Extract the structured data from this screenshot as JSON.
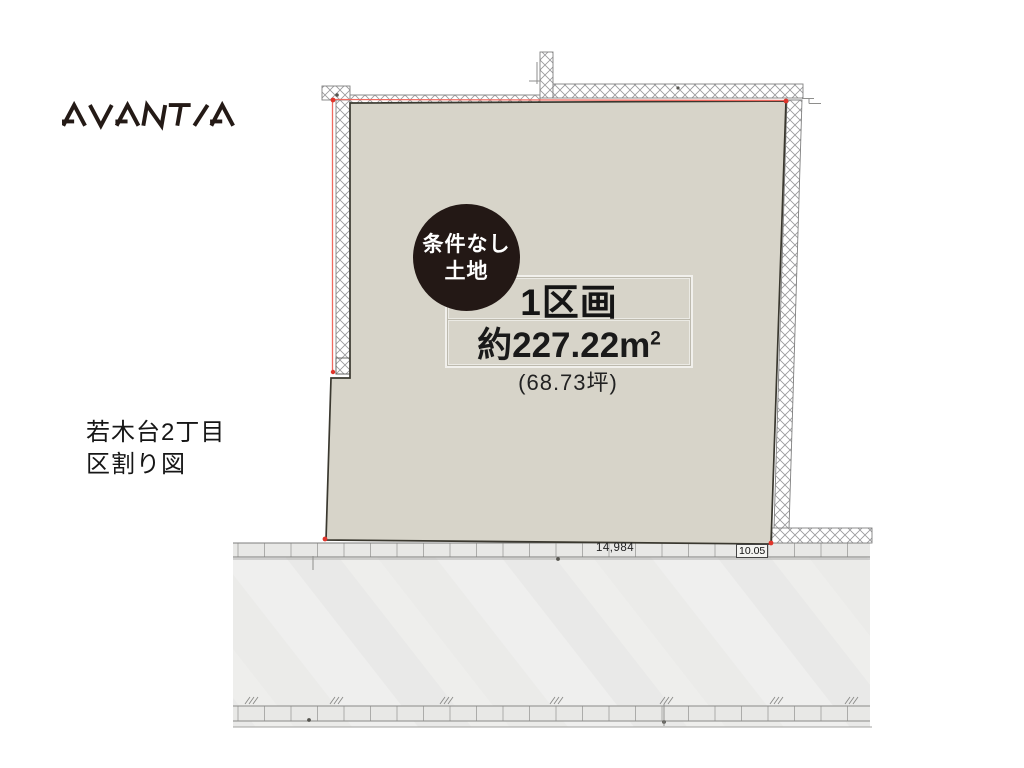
{
  "brand": {
    "name": "AVANTIA"
  },
  "map_title": {
    "line1": "若木台2丁目",
    "line2": "区割り図"
  },
  "badge": {
    "line1": "条件なし",
    "line2": "土地"
  },
  "lot": {
    "name": "1区画",
    "area_value": "約227.22",
    "area_unit": "m",
    "area_unit_sup": "2",
    "area_tsubo": "(68.73坪)"
  },
  "dimensions": {
    "frontage": "14,984",
    "road_width": "10.05"
  },
  "colors": {
    "plot_fill": "#d7d4c9",
    "boundary_red": "#e8564e",
    "badge_bg": "#231815",
    "road_fill": "#ededec",
    "hatch_line": "#98989a"
  }
}
